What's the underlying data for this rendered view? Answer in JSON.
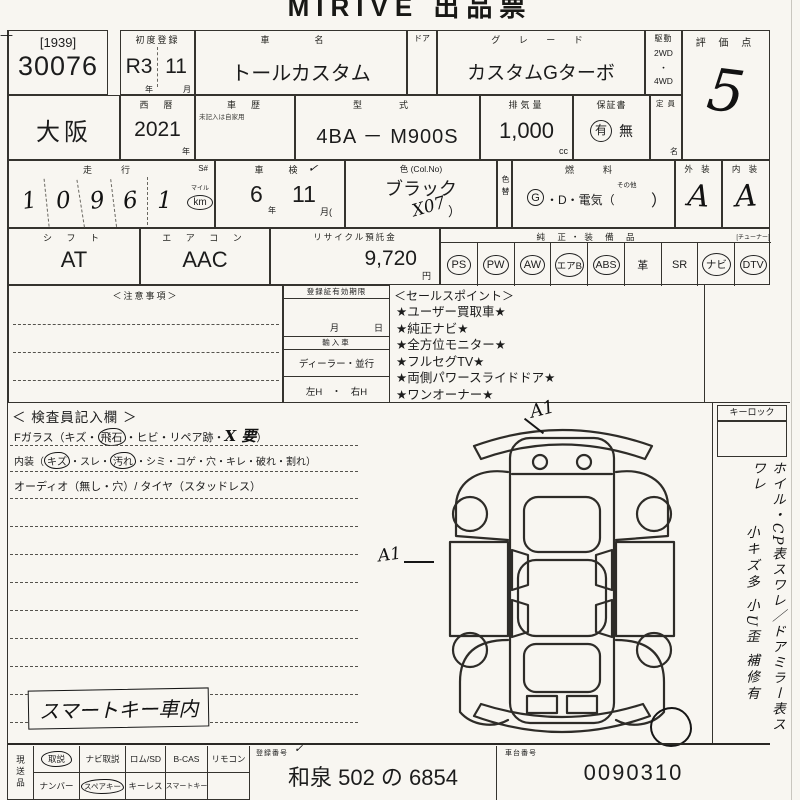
{
  "colors": {
    "paper": "#f8f6f1",
    "ink": "#1c1c1c",
    "line": "#35332e"
  },
  "header": {
    "title": "MIRIVE 出品票"
  },
  "lot": {
    "edge_mark": "—",
    "bracket": "[1939]",
    "number": "30076"
  },
  "first_reg": {
    "label": "初度登録",
    "era": "R3",
    "month": "11",
    "era_unit": "年",
    "month_unit": "月"
  },
  "car": {
    "name_label": "車　名",
    "name": "トールカスタム",
    "door_label": "ドア",
    "grade_label": "グ レ ー ド",
    "grade": "カスタムGターボ",
    "drive_label": "駆動",
    "drive_top": "2WD",
    "drive_dot": "・",
    "drive_bottom": "4WD"
  },
  "score": {
    "label": "評 価 点",
    "value": "5"
  },
  "row2": {
    "prefecture": "大阪",
    "year_label": "西　暦",
    "year": "2021",
    "year_unit": "年",
    "history_label": "車　歴",
    "history_note": "未記入は自家用",
    "model_label": "型　式",
    "model": "4BA － M900S",
    "disp_label": "排気量",
    "disp": "1,000",
    "disp_unit": "cc",
    "warranty_label": "保証書",
    "warranty_yes": "有",
    "warranty_no": "無",
    "capacity_label": "定 員",
    "capacity_unit": "名"
  },
  "row3": {
    "mileage_label": "走　行",
    "s_label": "S#",
    "digits": [
      "1",
      "0",
      "9",
      "6",
      "1"
    ],
    "mile_label": "マイル",
    "km_label": "km",
    "inspection_label": "車　検",
    "inspection_tick": "✓",
    "insp_year": "6",
    "insp_year_unit": "年",
    "insp_month": "11",
    "insp_month_unit": "月(",
    "color_label": "色 (Col.No)",
    "color": "ブラック",
    "color_code": "X07",
    "color_code_close": "）",
    "color_change_label": "色替",
    "fuel_label": "燃　料",
    "fuel_g": "G",
    "fuel_rest": "・D・電気（",
    "fuel_other": "その他",
    "fuel_close": "）",
    "exterior_label": "外 装",
    "exterior": "A",
    "interior_label": "内 装",
    "interior": "A"
  },
  "row4": {
    "shift_label": "シ フ ト",
    "shift": "AT",
    "aircon_label": "エ ア コ ン",
    "aircon": "AAC",
    "recycle_label": "リサイクル預託金",
    "recycle": "9,720",
    "recycle_unit": "円",
    "equipment_label": "純 正・装 備 品",
    "tuner_label": "[チューナー]",
    "equipment": [
      {
        "text": "PS",
        "circled": true
      },
      {
        "text": "PW",
        "circled": true
      },
      {
        "text": "AW",
        "circled": true
      },
      {
        "text": "エアB",
        "circled": true
      },
      {
        "text": "ABS",
        "circled": true
      },
      {
        "text": "革",
        "circled": false
      },
      {
        "text": "SR",
        "circled": false
      },
      {
        "text": "ナビ",
        "circled": true
      },
      {
        "text": "DTV",
        "circled": true
      }
    ]
  },
  "notes": {
    "label": "＜注意事項＞"
  },
  "registration": {
    "label": "登録証有効期限",
    "month": "月",
    "day": "日",
    "import_label": "輸入車",
    "dealer": "ディーラー・並行",
    "handle": "左H　・　右H"
  },
  "sales": {
    "label": "＜セールスポイント＞",
    "items": [
      "★ユーザー買取車★",
      "★純正ナビ★",
      "★全方位モニター★",
      "★フルセグTV★",
      "★両側パワースライドドア★",
      "★ワンオーナー★"
    ]
  },
  "inspector": {
    "title": "＜ 検査員記入欄 ＞",
    "fglass_pre": "Fガラス（キズ・",
    "fglass_circled": "飛石",
    "fglass_mid": "・ヒビ・リペア跡・",
    "fglass_hand": "X 要",
    "fglass_post": "）",
    "interior_pre": "内装（",
    "interior_c1": "キズ",
    "interior_m1": "・スレ・",
    "interior_c2": "汚れ",
    "interior_post": "・シミ・コゲ・穴・キレ・破れ・割れ）",
    "audio_line": "オーディオ（無し・穴）/ タイヤ（スタッドレス）",
    "hand_note": "スマートキー車内"
  },
  "diagram": {
    "mark_front": "A1",
    "mark_side": "A1"
  },
  "right_col": {
    "keylock": "キーロック",
    "vertical_1": "ホイル・CP表スワレ／ドアミラー表スワレ",
    "vertical_2": "小キズ多 小U歪 補修有"
  },
  "bottom": {
    "side_label": "現送品",
    "row1": [
      {
        "text": "取説",
        "circled": true
      },
      {
        "text": "ナビ取説",
        "circled": false
      },
      {
        "text": "ロム/SD",
        "circled": false
      },
      {
        "text": "B-CAS",
        "circled": false
      },
      {
        "text": "リモコン",
        "circled": false
      }
    ],
    "row2": [
      {
        "text": "ナンバー",
        "circled": false
      },
      {
        "text": "スペアキー",
        "circled": true
      },
      {
        "text": "キーレス",
        "circled": false
      },
      {
        "text": "スマートキー",
        "circled": false
      },
      {
        "text": "",
        "circled": false
      }
    ],
    "reg_label": "登録番号",
    "reg_tick": "✓",
    "reg_value": "和泉 502 の 6854",
    "chassis_label": "車台番号",
    "chassis_value": "0090310"
  }
}
